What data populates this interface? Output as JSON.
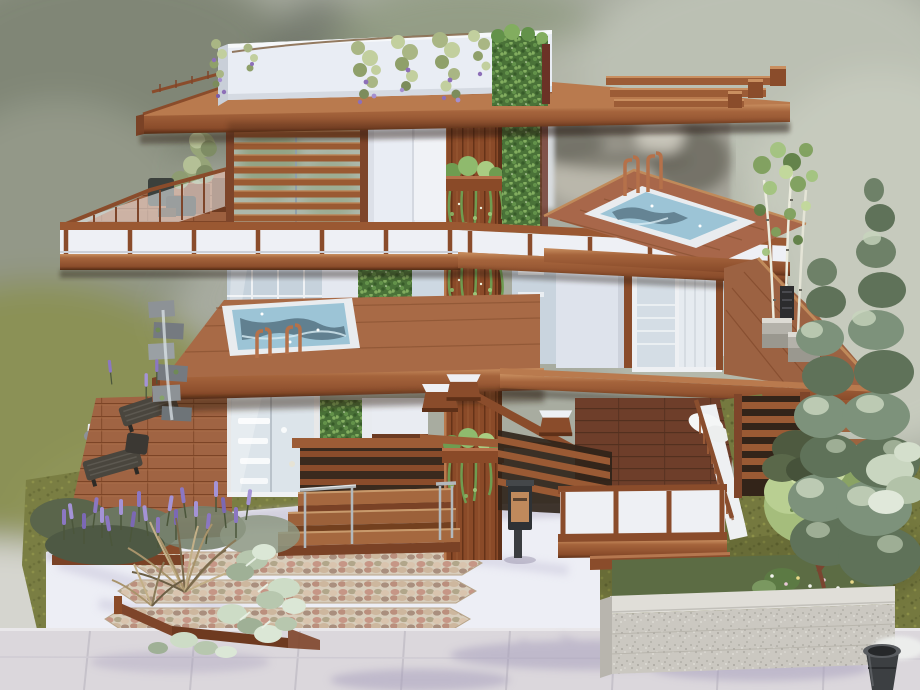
{
  "scene": {
    "description": "Blurred-background render of a modern three-storey timber house with rooftop planter parapet, roof terrace, two raised spa pools, living green walls, glass railings and a landscaped front yard",
    "style": "life-sim build showcase screenshot",
    "objects": [
      "white rooftop parapet with trailing wisteria",
      "ivy corner block on parapet",
      "wood pergola beams on roof",
      "roof terrace with glass railing, chairs and shrub planters",
      "horizontal wood louver screen",
      "central timber pillar with hanging planters",
      "living green wall panels",
      "raised spa pool with chrome ladder rails",
      "second spa pool on rear roof deck",
      "blurred stone feature wall",
      "sliding glass doors and white wall panels",
      "cantilevered wood floor slabs with white balustrade bands",
      "first-floor glass wall with shelving inside",
      "glass entry door with wood frame",
      "two slatted lounge chairs on deck",
      "stacked-stone water feature",
      "lavender bed and ornamental grasses",
      "pale dusty-miller shrubs and wood planter edging",
      "wide wood entry steps with steel handrails",
      "mailbox with copper panel",
      "slatted porch privacy fences",
      "porch with white balustrade panels and baluster rail",
      "potted birch trees in concrete planters",
      "tall cypress trees",
      "stone planter wall with small ornamental tree and flowers",
      "white concrete path with pebble-mosaic stepping strips",
      "sidewalk with tree shadows",
      "dark trash pot"
    ]
  },
  "palette": {
    "background": "#a8aca0",
    "wood_light": "#c98f60",
    "wood_mid": "#9c5c36",
    "wood_dark": "#6e3a20",
    "deck": "#a06443",
    "deck_dark": "#6e3e2a",
    "white_wall": "#e9edf4",
    "panel_blue": "#dee3ec",
    "glass": "#c9d4de",
    "water": "#9cc4d6",
    "water_deep": "#4e6a78",
    "leaf_dark": "#4a7238",
    "leaf_mid": "#6f9c50",
    "leaf_light": "#9cc477",
    "lawn": "#75793f",
    "lavender": "#8b77c2",
    "grass_tan": "#b3a079",
    "path_white": "#edeef5",
    "sidewalk": "#dbd7dc",
    "granite": "#cbc8c1",
    "copper": "#b5714a",
    "steel": "#b2b8bc",
    "cypress": "#7d927b",
    "cypress_light": "#c7d4bd",
    "stone_wall_blur": "#a5a399",
    "parapet_white": "#e9edf4"
  }
}
